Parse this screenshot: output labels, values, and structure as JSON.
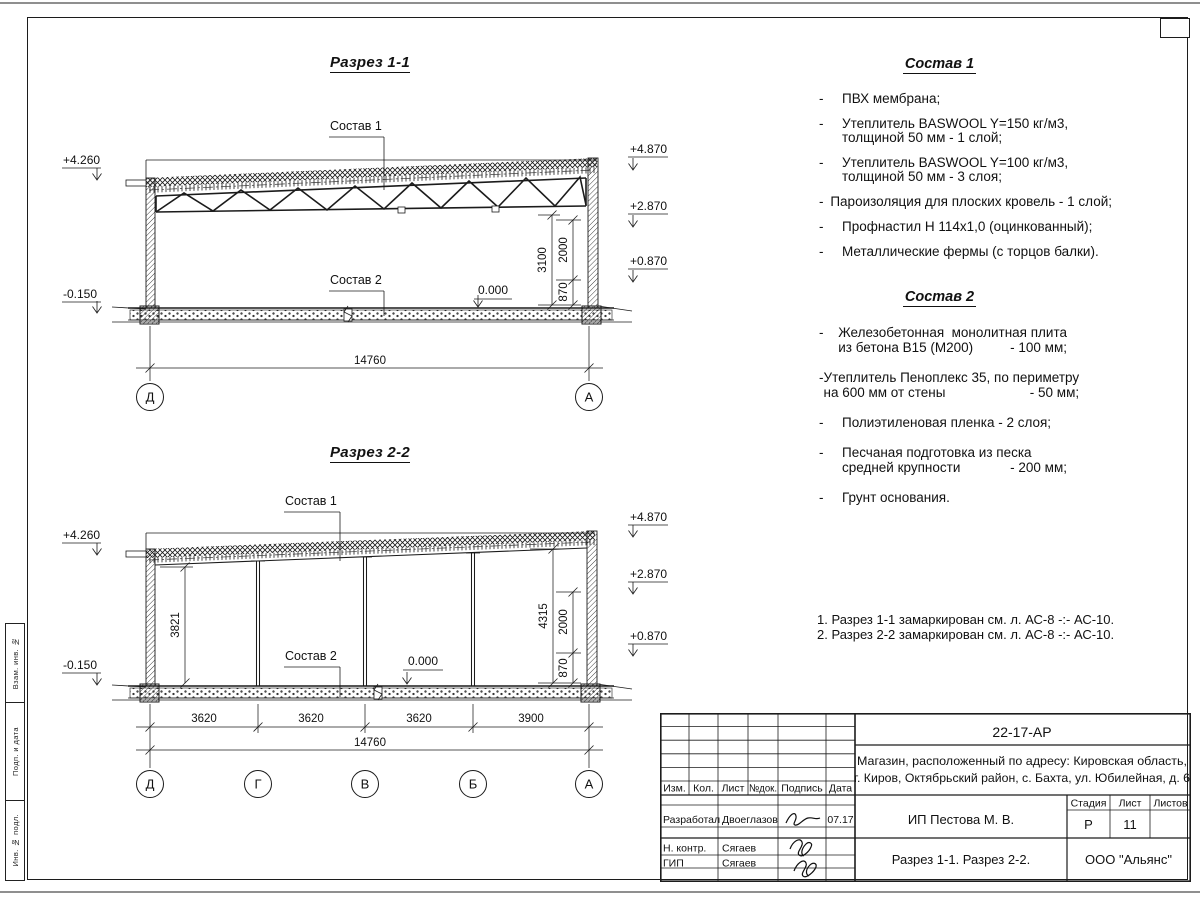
{
  "margin_labels": [
    "Взам. инв. №",
    "Подп. и дата",
    "Инв. № подл."
  ],
  "section1": {
    "title": "Разрез 1-1",
    "leader1": "Состав 1",
    "leader2": "Состав 2",
    "zero": "0.000",
    "elev_left": [
      "+4.260",
      "-0.150"
    ],
    "elev_right": [
      "+4.870",
      "+2.870",
      "+0.870"
    ],
    "vdims": [
      "3100",
      "2000",
      "870"
    ],
    "total": "14760",
    "axes": [
      "Д",
      "А"
    ]
  },
  "section2": {
    "title": "Разрез 2-2",
    "leader1": "Состав 1",
    "leader2": "Состав 2",
    "zero": "0.000",
    "elev_left": [
      "+4.260",
      "-0.150"
    ],
    "elev_right": [
      "+4.870",
      "+2.870",
      "+0.870"
    ],
    "vdims": [
      "3821",
      "4315",
      "2000",
      "870"
    ],
    "bottom": [
      "3620",
      "3620",
      "3620",
      "3900"
    ],
    "total": "14760",
    "axes": [
      "Д",
      "Г",
      "В",
      "Б",
      "А"
    ]
  },
  "sostav1": {
    "title": "Состав 1",
    "items": [
      {
        "lines": [
          "ПВХ мембрана;"
        ]
      },
      {
        "lines": [
          "Утеплитель BASWOOL Y=150 кг/м3,",
          "толщиной 50 мм - 1 слой;"
        ]
      },
      {
        "lines": [
          "Утеплитель BASWOOL Y=100 кг/м3,",
          "толщиной 50 мм - 3 слоя;"
        ]
      },
      {
        "lines": [
          "Пароизоляция для плоских кровель - 1 слой;"
        ]
      },
      {
        "lines": [
          "Профнастил Н 114х1,0 (оцинкованный);"
        ]
      },
      {
        "lines": [
          "Металлические фермы (с торцов балки)."
        ]
      }
    ]
  },
  "sostav2": {
    "title": "Состав 2",
    "items": [
      {
        "lines": [
          "Железобетонная  монолитная плита",
          "из бетона В15 (М200)"
        ],
        "value": "- 100 мм;"
      },
      {
        "lines": [
          "Утеплитель Пеноплекс 35, по периметру",
          "на 600 мм от стены"
        ],
        "value": "- 50 мм;"
      },
      {
        "lines": [
          "Полиэтиленовая пленка - 2 слоя;"
        ]
      },
      {
        "lines": [
          "Песчаная подготовка из песка",
          "средней крупности"
        ],
        "value": "- 200 мм;"
      },
      {
        "lines": [
          "Грунт основания."
        ]
      }
    ]
  },
  "notes": [
    "1. Разрез 1-1 замаркирован см. л. АС-8 -:- АС-10.",
    "2. Разрез 2-2 замаркирован см. л. АС-8 -:- АС-10."
  ],
  "titleblock": {
    "doc_code": "22-17-АР",
    "project_line1": "Магазин, расположенный по адресу: Кировская область,",
    "project_line2": "г. Киров, Октябрьский район, с. Бахта, ул. Юбилейная, д. 6",
    "cols": [
      "Изм.",
      "Кол.",
      "Лист",
      "№док.",
      "Подпись",
      "Дата"
    ],
    "row1_role": "Разработал",
    "row1_name": "Двоеглазов",
    "row1_date": "07.17",
    "row2_role": "Н. контр.",
    "row2_name": "Сягаев",
    "row3_role": "ГИП",
    "row3_name": "Сягаев",
    "client": "ИП Пестова М. В.",
    "stage_label": "Стадия",
    "sheet_label": "Лист",
    "sheets_label": "Листов",
    "stage": "Р",
    "sheet_no": "11",
    "sheets_total": "",
    "drawing_title": "Разрез 1-1. Разрез 2-2.",
    "company": "ООО \"Альянс\""
  }
}
